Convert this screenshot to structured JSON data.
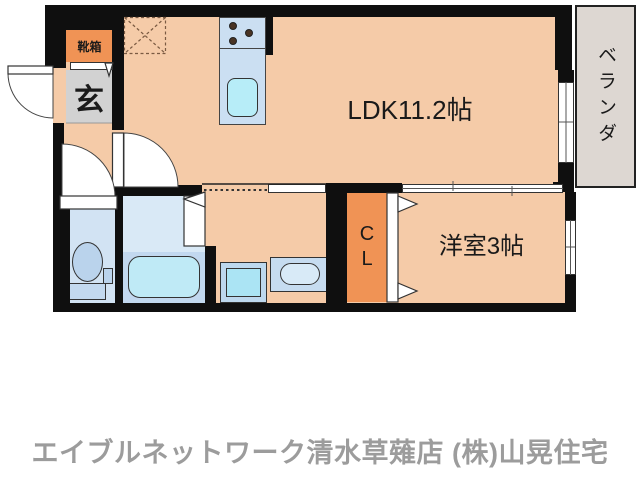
{
  "floorplan": {
    "labels": {
      "ldk": "LDK11.2帖",
      "western_room": "洋室3帖",
      "closet": "CL",
      "entrance": "玄",
      "shoe_box": "靴箱",
      "balcony": "ベランダ"
    },
    "colors": {
      "wall": "#0f0f0f",
      "floor_salmon": "#f5cba8",
      "accent_orange": "#f09355",
      "entrance_gray": "#d2d2d2",
      "balcony_gray": "#ddd7d2",
      "wet_room_blue": "#d9e9f6",
      "bath_lower_blue": "#c2d8ef",
      "fixture_cyan": "#b7edf8",
      "footer_gray": "#9c9c9c"
    }
  },
  "footer": {
    "store_name": "エイブルネットワーク清水草薙店 (株)山晃住宅"
  }
}
